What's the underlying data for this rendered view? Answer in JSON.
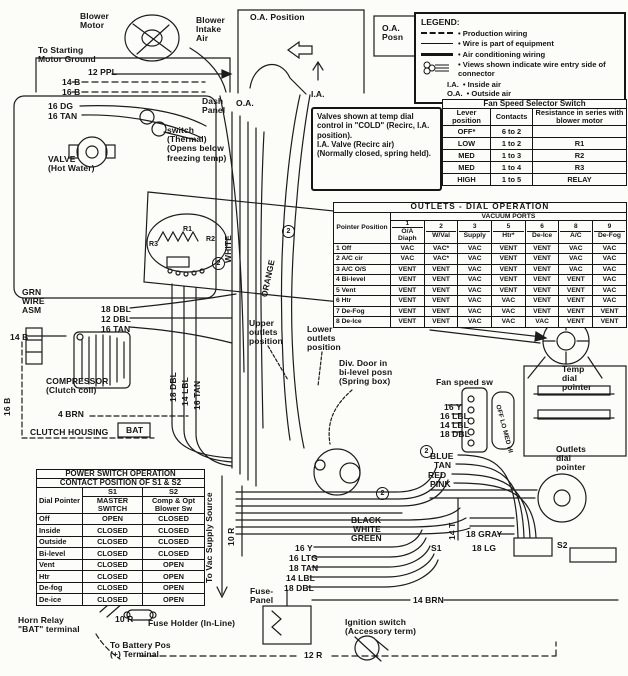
{
  "legend": {
    "title": "LEGEND:",
    "items": [
      {
        "style": "dashed",
        "label": "Production wiring"
      },
      {
        "style": "thin",
        "label": "Wire is part of equipment"
      },
      {
        "style": "thick",
        "label": "Air conditioning wiring"
      },
      {
        "style": "connector",
        "label": "Views shown indicate wire entry side of connector"
      }
    ],
    "abbreviations": [
      {
        "abbr": "I.A.",
        "meaning": "Inside air"
      },
      {
        "abbr": "O.A.",
        "meaning": "Outside air"
      }
    ]
  },
  "fan_speed_switch": {
    "title": "Fan Speed Selector Switch",
    "headers": [
      "Lever position",
      "Contacts",
      "Resistance in series with blower motor"
    ],
    "rows": [
      [
        "OFF*",
        "6 to 2",
        ""
      ],
      [
        "LOW",
        "1 to 2",
        "R1"
      ],
      [
        "MED",
        "1 to 3",
        "R2"
      ],
      [
        "MED",
        "1 to 4",
        "R3"
      ],
      [
        "HIGH",
        "1 to 5",
        "RELAY"
      ]
    ]
  },
  "outlets_dial": {
    "title": "OUTLETS - DIAL OPERATION",
    "corner": "Pointer Position",
    "ports_header": "VACUUM PORTS",
    "ports": [
      {
        "num": "1",
        "name": "O/A Diaph"
      },
      {
        "num": "2",
        "name": "W/Val"
      },
      {
        "num": "3",
        "name": "Supply"
      },
      {
        "num": "5",
        "name": "Htr*"
      },
      {
        "num": "6",
        "name": "De-Ice"
      },
      {
        "num": "8",
        "name": "A/C"
      },
      {
        "num": "9",
        "name": "De-Fog"
      }
    ],
    "rows": [
      {
        "label": "1 Off",
        "cells": [
          "VAC",
          "VAC*",
          "VAC",
          "VENT",
          "VENT",
          "VAC",
          "VAC"
        ]
      },
      {
        "label": "2 A/C cir",
        "cells": [
          "VAC",
          "VAC*",
          "VAC",
          "VENT",
          "VENT",
          "VAC",
          "VAC"
        ]
      },
      {
        "label": "3 A/C O/S",
        "cells": [
          "VENT",
          "VENT",
          "VAC",
          "VENT",
          "VENT",
          "VAC",
          "VAC"
        ]
      },
      {
        "label": "4 Bi-level",
        "cells": [
          "VENT",
          "VENT",
          "VAC",
          "VENT",
          "VENT",
          "VENT",
          "VAC"
        ]
      },
      {
        "label": "5 Vent",
        "cells": [
          "VENT",
          "VENT",
          "VAC",
          "VENT",
          "VENT",
          "VENT",
          "VAC"
        ]
      },
      {
        "label": "6 Htr",
        "cells": [
          "VENT",
          "VENT",
          "VAC",
          "VAC",
          "VENT",
          "VENT",
          "VAC"
        ]
      },
      {
        "label": "7 De-Fog",
        "cells": [
          "VENT",
          "VENT",
          "VAC",
          "VAC",
          "VENT",
          "VENT",
          "VENT"
        ]
      },
      {
        "label": "8 De-Ice",
        "cells": [
          "VENT",
          "VENT",
          "VAC",
          "VAC",
          "VAC",
          "VENT",
          "VENT"
        ]
      }
    ]
  },
  "power_switch": {
    "title": "POWER SWITCH OPERATION",
    "subtitle": "CONTACT POSITION OF S1 & S2",
    "corner": "Dial Pointer",
    "s1_id": "S1",
    "s1_name": "MASTER SWITCH",
    "s2_id": "S2",
    "s2_name": "Comp & Opt Blower Sw",
    "rows": [
      {
        "dial": "Off",
        "s1": "OPEN",
        "s2": "CLOSED"
      },
      {
        "dial": "Inside",
        "s1": "CLOSED",
        "s2": "CLOSED"
      },
      {
        "dial": "Outside",
        "s1": "CLOSED",
        "s2": "CLOSED"
      },
      {
        "dial": "Bi-level",
        "s1": "CLOSED",
        "s2": "CLOSED"
      },
      {
        "dial": "Vent",
        "s1": "CLOSED",
        "s2": "OPEN"
      },
      {
        "dial": "Htr",
        "s1": "CLOSED",
        "s2": "OPEN"
      },
      {
        "dial": "De-fog",
        "s1": "CLOSED",
        "s2": "OPEN"
      },
      {
        "dial": "De-ice",
        "s1": "CLOSED",
        "s2": "OPEN"
      }
    ]
  },
  "note": {
    "text": "Valves shown at temp dial control in \"COLD\" (Recirc, I.A. position).\nI.A. Valve (Recirc air)\n(Normally closed, spring held)."
  },
  "labels": [
    {
      "name": "blower-motor-label",
      "text": "Blower\nMotor",
      "x": 80,
      "y": 12
    },
    {
      "name": "blower-intake-air-label",
      "text": "Blower\nIntake\nAir",
      "x": 196,
      "y": 16
    },
    {
      "name": "oa-position-label",
      "text": "O.A. Position",
      "x": 250,
      "y": 13
    },
    {
      "name": "oa-posn-label",
      "text": "O.A.\nPosn",
      "x": 382,
      "y": 24
    },
    {
      "name": "starting-motor-ground-label",
      "text": "To Starting\nMotor Ground",
      "x": 38,
      "y": 46
    },
    {
      "name": "wire-12ppl-label",
      "text": "12 PPL",
      "x": 88,
      "y": 68
    },
    {
      "name": "wire-14b-label",
      "text": "14 B",
      "x": 62,
      "y": 78
    },
    {
      "name": "wire-16b-label",
      "text": "16 B",
      "x": 62,
      "y": 88
    },
    {
      "name": "wire-16dg-label",
      "text": "16 DG",
      "x": 48,
      "y": 102
    },
    {
      "name": "wire-16tan-label",
      "text": "16 TAN",
      "x": 48,
      "y": 112
    },
    {
      "name": "dash-panel-label",
      "text": "Dash\nPanel",
      "x": 202,
      "y": 97
    },
    {
      "name": "ia-label",
      "text": "I.A.",
      "x": 311,
      "y": 90
    },
    {
      "name": "oa-label",
      "text": "O.A.",
      "x": 236,
      "y": 99
    },
    {
      "name": "thermal-switch-label",
      "text": "switch\n(Thermal)\n(Opens below\nfreezing temp)",
      "x": 167,
      "y": 126
    },
    {
      "name": "hot-water-valve-label",
      "text": "VALVE\n(Hot Water)",
      "x": 48,
      "y": 155
    },
    {
      "name": "white-wire-vert-label",
      "text": "WHITE",
      "x": 224,
      "y": 263,
      "rot": -90
    },
    {
      "name": "orange-wire-vert-label",
      "text": "ORANGE",
      "x": 260,
      "y": 296,
      "rot": -78
    },
    {
      "name": "resistor-r1-label",
      "text": "R1",
      "x": 183,
      "y": 226,
      "size": 7
    },
    {
      "name": "resistor-r2-label",
      "text": "R2",
      "x": 206,
      "y": 236,
      "size": 7
    },
    {
      "name": "resistor-r3-label",
      "text": "R3",
      "x": 149,
      "y": 241,
      "size": 7
    },
    {
      "name": "grn-wire-asm-label",
      "text": "GRN\nWIRE\nASM",
      "x": 22,
      "y": 288
    },
    {
      "name": "wire-18dbl-label-a",
      "text": "18 DBL",
      "x": 101,
      "y": 305
    },
    {
      "name": "wire-12dbl-label",
      "text": "12 DBL",
      "x": 101,
      "y": 315
    },
    {
      "name": "wire-16tan-label-b",
      "text": "16 TAN",
      "x": 101,
      "y": 325
    },
    {
      "name": "wire-14b-label-b",
      "text": "14 B",
      "x": 10,
      "y": 333
    },
    {
      "name": "upper-outlets-label",
      "text": "Upper\noutlets\nposition",
      "x": 249,
      "y": 319
    },
    {
      "name": "lower-outlets-label",
      "text": "Lower\noutlets\nposition",
      "x": 307,
      "y": 325
    },
    {
      "name": "temp-cable-label",
      "text": "TEMP CABLE",
      "x": 391,
      "y": 318
    },
    {
      "name": "div-door-label",
      "text": "Div. Door in\nbi-level posn\n(Spring box)",
      "x": 339,
      "y": 359
    },
    {
      "name": "temp-dial-pointer-label",
      "text": "Temp\ndial\npointer",
      "x": 562,
      "y": 365
    },
    {
      "name": "fan-speed-sw-label",
      "text": "Fan speed sw",
      "x": 436,
      "y": 378
    },
    {
      "name": "wire-16y-label-a",
      "text": "16 Y",
      "x": 444,
      "y": 403
    },
    {
      "name": "wire-16lbl-label",
      "text": "16 LBL",
      "x": 440,
      "y": 412
    },
    {
      "name": "wire-14lbl-label-a",
      "text": "14 LBL",
      "x": 440,
      "y": 421
    },
    {
      "name": "wire-18dbl-label-b",
      "text": "18 DBL",
      "x": 440,
      "y": 430
    },
    {
      "name": "wire-18dbl-vert-label",
      "text": "18 DBL",
      "x": 169,
      "y": 402,
      "rot": -90
    },
    {
      "name": "wire-14lbl-vert-label",
      "text": "14 LBL",
      "x": 181,
      "y": 406,
      "rot": -90
    },
    {
      "name": "wire-16tan-vert-label",
      "text": "16 TAN",
      "x": 193,
      "y": 410,
      "rot": -90
    },
    {
      "name": "compressor-label",
      "text": "COMPRESSOR\n(Clutch coil)",
      "x": 46,
      "y": 377
    },
    {
      "name": "wire-4brn-label",
      "text": "4 BRN",
      "x": 58,
      "y": 410
    },
    {
      "name": "clutch-housing-label",
      "text": "CLUTCH HOUSING",
      "x": 30,
      "y": 428
    },
    {
      "name": "bat-terminal-label",
      "text": "BAT",
      "x": 126,
      "y": 426
    },
    {
      "name": "wire-blue-label",
      "text": "BLUE",
      "x": 430,
      "y": 452
    },
    {
      "name": "wire-tan-label",
      "text": "TAN",
      "x": 434,
      "y": 461
    },
    {
      "name": "wire-red-label",
      "text": "RED",
      "x": 428,
      "y": 471
    },
    {
      "name": "wire-pink-label",
      "text": "PINK",
      "x": 430,
      "y": 480
    },
    {
      "name": "outlets-dial-pointer-label",
      "text": "Outlets\ndial\npointer",
      "x": 556,
      "y": 445
    },
    {
      "name": "wire-black-label",
      "text": "BLACK",
      "x": 351,
      "y": 516
    },
    {
      "name": "wire-white-label",
      "text": "WHITE",
      "x": 353,
      "y": 525
    },
    {
      "name": "wire-green-label",
      "text": "GREEN",
      "x": 351,
      "y": 534
    },
    {
      "name": "wire-18gray-label",
      "text": "18 GRAY",
      "x": 466,
      "y": 530
    },
    {
      "name": "switch-s1-label",
      "text": "S1",
      "x": 431,
      "y": 544
    },
    {
      "name": "wire-18lg-label",
      "text": "18 LG",
      "x": 472,
      "y": 544
    },
    {
      "name": "switch-s2-label",
      "text": "S2",
      "x": 557,
      "y": 541
    },
    {
      "name": "to-vac-supply-label",
      "text": "To Vac Supply Source",
      "x": 205,
      "y": 583,
      "rot": -90
    },
    {
      "name": "wire-10r-vert-label",
      "text": "10 R",
      "x": 227,
      "y": 546,
      "rot": -90
    },
    {
      "name": "wire-14t-vert-label",
      "text": "14 T",
      "x": 448,
      "y": 540,
      "rot": -90
    },
    {
      "name": "wire-16y-label-b",
      "text": "16 Y",
      "x": 295,
      "y": 544
    },
    {
      "name": "wire-16ltg-label",
      "text": "16 LTG",
      "x": 289,
      "y": 554
    },
    {
      "name": "wire-18tan-label",
      "text": "18 TAN",
      "x": 289,
      "y": 564
    },
    {
      "name": "wire-14lbl-label-b",
      "text": "14 LBL",
      "x": 286,
      "y": 574
    },
    {
      "name": "wire-18dbl-label-c",
      "text": "18 DBL",
      "x": 284,
      "y": 584
    },
    {
      "name": "fuse-panel-label",
      "text": "Fuse-\nPanel",
      "x": 250,
      "y": 587
    },
    {
      "name": "wire-14brn-label",
      "text": "14 BRN",
      "x": 413,
      "y": 596
    },
    {
      "name": "ignition-switch-label",
      "text": "Ignition switch\n(Accessory term)",
      "x": 345,
      "y": 618
    },
    {
      "name": "horn-relay-label",
      "text": "Horn Relay\n\"BAT\" terminal",
      "x": 18,
      "y": 616
    },
    {
      "name": "wire-10r-label",
      "text": "10 R",
      "x": 115,
      "y": 615
    },
    {
      "name": "fuse-holder-label",
      "text": "Fuse Holder (In-Line)",
      "x": 148,
      "y": 619
    },
    {
      "name": "to-battery-label",
      "text": "To Battery Pos\n(+) Terminal",
      "x": 110,
      "y": 641
    },
    {
      "name": "wire-12r-label",
      "text": "12 R",
      "x": 304,
      "y": 651
    },
    {
      "name": "fan-dial-positions-label",
      "text": "OFF LO MED HI",
      "x": 501,
      "y": 404,
      "rot": 75,
      "size": 6.5
    },
    {
      "name": "connector-2-marker-a",
      "text": "2",
      "x": 282,
      "y": 225,
      "cls": "circ"
    },
    {
      "name": "connector-2-marker-b",
      "text": "2",
      "x": 212,
      "y": 257,
      "cls": "circ"
    },
    {
      "name": "connector-2-marker-c",
      "text": "2",
      "x": 420,
      "y": 445,
      "cls": "circ"
    },
    {
      "name": "connector-2-marker-d",
      "text": "2",
      "x": 376,
      "y": 487,
      "cls": "circ"
    },
    {
      "name": "wire-16b-vert-label",
      "text": "16 B",
      "x": 3,
      "y": 416,
      "rot": -90
    }
  ]
}
